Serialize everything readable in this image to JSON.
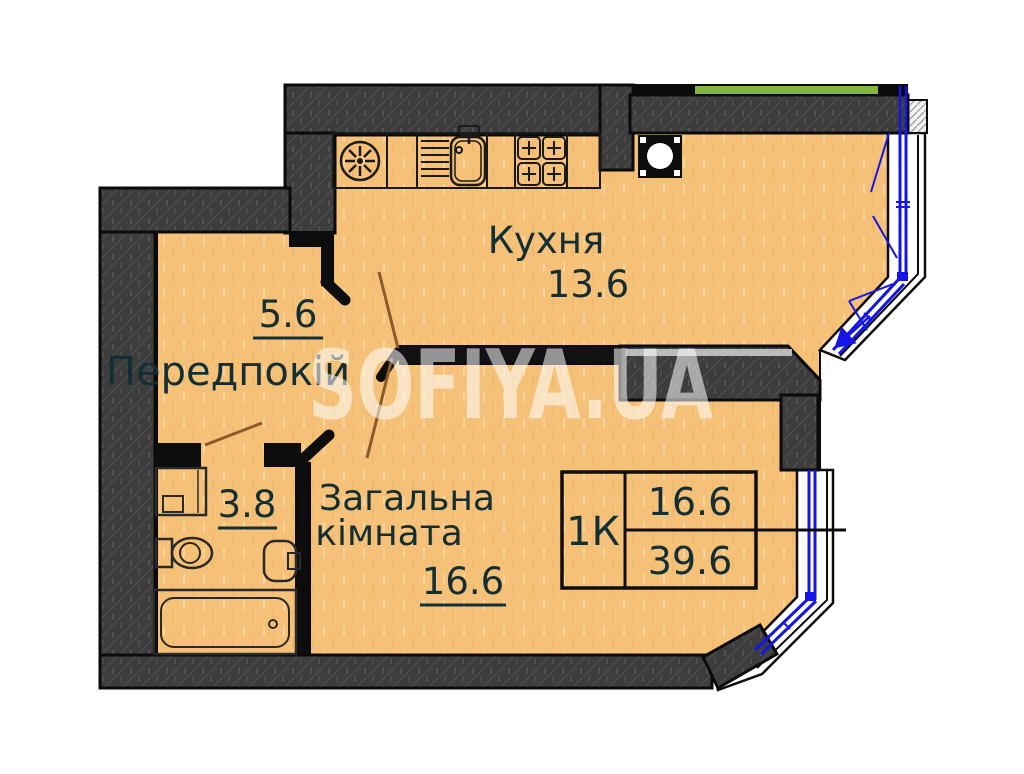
{
  "watermark": "SOFIYA.UA",
  "rooms": {
    "kitchen": {
      "name": "Кухня",
      "area": "13.6"
    },
    "hallway": {
      "name": "Передпокій",
      "area": "5.6"
    },
    "bathroom": {
      "area": "3.8"
    },
    "living_room": {
      "name_line1": "Загальна",
      "name_line2": "кімната",
      "area": "16.6"
    }
  },
  "info_table": {
    "apartment_type": "1К",
    "room_area": "16.6",
    "total_area": "39.6"
  },
  "colors": {
    "floor": "#f5c178",
    "wall": "#3d3d3d",
    "wall_outline": "#0b0b0b",
    "window_blue": "#1515e6",
    "facade_green": "#82b440",
    "door_swing_brown": "#8a5a2a",
    "label_text": "#142f33",
    "watermark_white": "#ffffff"
  },
  "icons": {
    "fan-icon": "circle with 8 radial blades (hob/vent)",
    "kitchen-sink-icon": "sink bowl with faucet and drying rack",
    "stove-icon": "4-burner stove with cross marks",
    "vent-shaft-icon": "black square with white circle",
    "washing-machine-icon": "square with small door rectangle",
    "toilet-icon": "tank with oval bowl",
    "bathroom-sink-icon": "rounded wall-hung basin",
    "bathtub-icon": "rectangle with rounded inner tub and drain",
    "window-opening-arrow-icon": "blue arrow showing casement opening"
  }
}
